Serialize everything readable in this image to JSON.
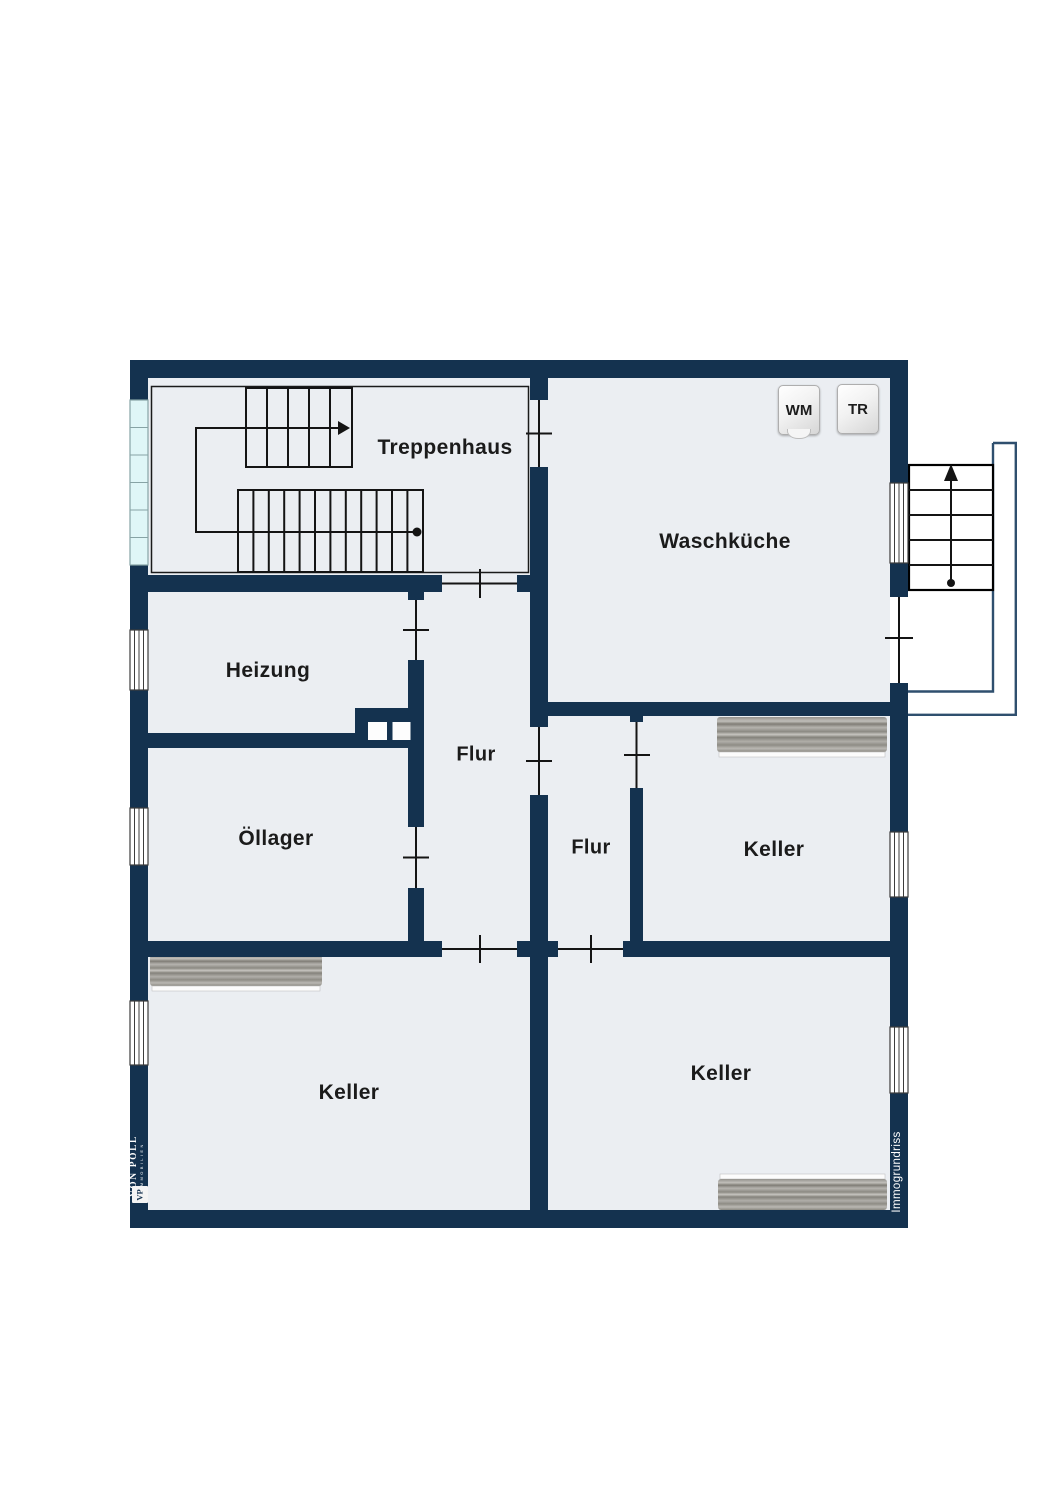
{
  "plan": {
    "type": "basement-floor-plan",
    "rooms": [
      {
        "id": "treppenhaus",
        "label": "Treppenhaus"
      },
      {
        "id": "waschkueche",
        "label": "Waschküche"
      },
      {
        "id": "heizung",
        "label": "Heizung"
      },
      {
        "id": "oellager",
        "label": "Öllager"
      },
      {
        "id": "flur_main",
        "label": "Flur"
      },
      {
        "id": "flur_small",
        "label": "Flur"
      },
      {
        "id": "keller_mid_right",
        "label": "Keller"
      },
      {
        "id": "keller_bottom_left",
        "label": "Keller"
      },
      {
        "id": "keller_bottom_right",
        "label": "Keller"
      }
    ],
    "appliances": [
      {
        "id": "washing_machine",
        "label": "WM"
      },
      {
        "id": "dryer",
        "label": "TR"
      }
    ],
    "icons": [
      "interior-stairs-up-icon",
      "exterior-stairs-up-icon",
      "door-opening-icon",
      "window-icon",
      "glass-block-band-icon",
      "chimney-flues-icon",
      "shelf-workbench-icon"
    ]
  },
  "branding": {
    "agency": "VON POLL",
    "agency_sub": "IMMOBILIEN",
    "monogram": "VP",
    "watermark": "Immogrundriss"
  },
  "colors": {
    "wall": "#14324f",
    "room": "#ebeef2",
    "glass": "#dff6f7",
    "stair_outline": "#2f4f6e",
    "label_text": "#1b1b1b",
    "shelf_gray": "#a3a19c"
  }
}
